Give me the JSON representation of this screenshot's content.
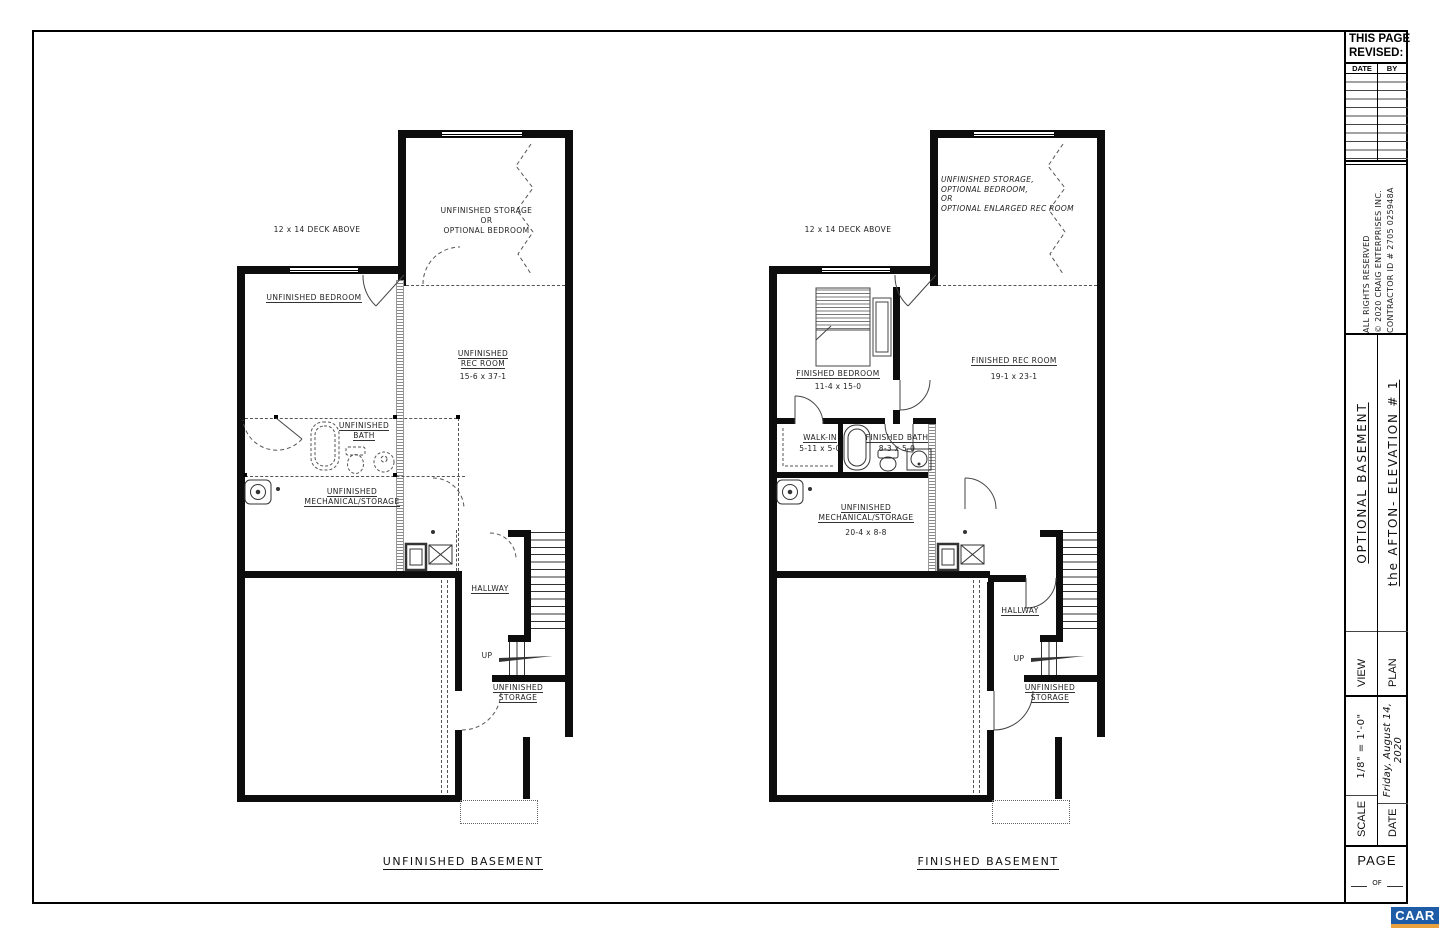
{
  "page": {
    "caption_left": "UNFINISHED BASEMENT",
    "caption_right": "FINISHED BASEMENT"
  },
  "plans": {
    "left": {
      "deck": "12 x 14 DECK ABOVE",
      "top_room": {
        "l1": "UNFINISHED STORAGE",
        "l2": "OR",
        "l3": "OPTIONAL BEDROOM"
      },
      "bedroom": "UNFINISHED BEDROOM",
      "rec": {
        "l1": "UNFINISHED",
        "l2": "REC ROOM",
        "dim": "15-6 x 37-1"
      },
      "bath": {
        "l1": "UNFINISHED",
        "l2": "BATH"
      },
      "mech": {
        "l1": "UNFINISHED",
        "l2": "MECHANICAL/STORAGE"
      },
      "hallway": "HALLWAY",
      "up": "UP",
      "storage": {
        "l1": "UNFINISHED",
        "l2": "STORAGE"
      }
    },
    "right": {
      "deck": "12 x 14 DECK ABOVE",
      "top_room": {
        "l1": "UNFINISHED STORAGE,",
        "l2": "OPTIONAL BEDROOM,",
        "l3": "OR",
        "l4": "OPTIONAL ENLARGED REC ROOM"
      },
      "bedroom": {
        "name": "FINISHED BEDROOM",
        "dim": "11-4 x 15-0"
      },
      "rec": {
        "name": "FINISHED REC ROOM",
        "dim": "19-1 x 23-1"
      },
      "walkin": {
        "name": "WALK-IN",
        "dim": "5-11 x 5-0"
      },
      "bath": {
        "name": "FINISHED BATH",
        "dim": "8-3 x 5-0"
      },
      "mech": {
        "l1": "UNFINISHED",
        "l2": "MECHANICAL/STORAGE",
        "dim": "20-4 x 8-8"
      },
      "hallway": "HALLWAY",
      "up": "UP",
      "storage": {
        "l1": "UNFINISHED",
        "l2": "STORAGE"
      }
    }
  },
  "title_block": {
    "this_page": "THIS PAGE",
    "revised": "REVISED:",
    "date_col": "DATE",
    "by_col": "BY",
    "rights": "ALL RIGHTS RESERVED",
    "copyright": "© 2020 CRAIG ENTERPRISES INC.",
    "contractor": "CONTRACTOR ID # 2705 025948A",
    "view_label": "VIEW",
    "view_value": "OPTIONAL BASEMENT",
    "plan_label": "PLAN",
    "plan_value": "the AFTON- ELEVATION # 1",
    "scale_label": "SCALE",
    "scale_value": "1/8\" = 1'-0\"",
    "date_label": "DATE",
    "date_value": "Friday, August 14, 2020",
    "page_label": "PAGE",
    "of_label": "OF",
    "caar": "CAAR"
  },
  "colors": {
    "caar_blue": "#1e5ca8",
    "caar_orange": "#e9a13e"
  }
}
